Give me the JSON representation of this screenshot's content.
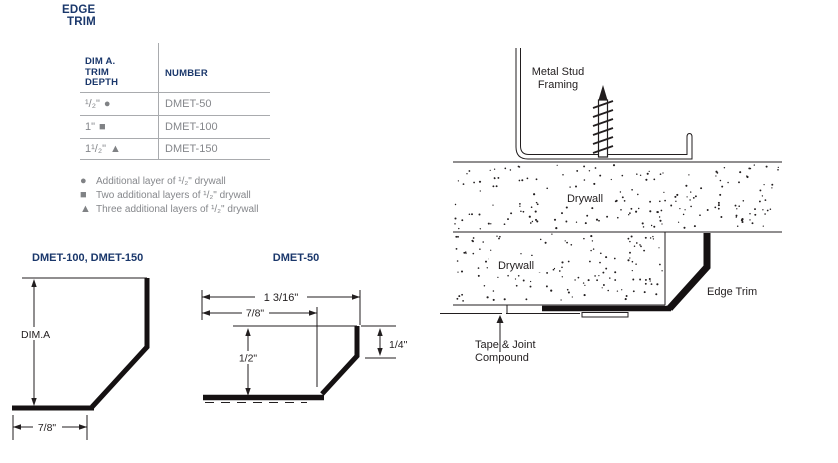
{
  "colors": {
    "navy": "#1a376b",
    "gray_text": "#85878b",
    "marker_gray": "#808285",
    "line_black": "#221e1f"
  },
  "page_title": {
    "line1": "EDGE",
    "line2": "TRIM"
  },
  "table": {
    "col1_header": "DIM A.\nTRIM\nDEPTH",
    "col2_header": "NUMBER",
    "rows": [
      {
        "depth": "¹/₂\"",
        "marker": "●",
        "marker_name": "circle",
        "number": "DMET-50"
      },
      {
        "depth": "1\"",
        "marker": "■",
        "marker_name": "square",
        "number": "DMET-100"
      },
      {
        "depth": "1¹/₂\"",
        "marker": "▲",
        "marker_name": "triangle",
        "number": "DMET-150"
      }
    ]
  },
  "legend": [
    {
      "marker": "●",
      "text": "Additional layer of ¹/₂\" drywall"
    },
    {
      "marker": "■",
      "text": "Two additional layers of ¹/₂\" drywall"
    },
    {
      "marker": "▲",
      "text": "Three additional layers of ¹/₂\" drywall"
    }
  ],
  "drawing_left": {
    "title": "DMET-100, DMET-150",
    "dim_vertical": "DIM.A",
    "dim_bottom": "7/8\""
  },
  "drawing_mid": {
    "title": "DMET-50",
    "dim_top": "1 3/16\"",
    "dim_second": "7/8\"",
    "dim_left": "1/2\"",
    "dim_right": "1/4\""
  },
  "installation": {
    "framing_line1": "Metal Stud",
    "framing_line2": "Framing",
    "drywall_top_label": "Drywall",
    "drywall_bottom_label": "Drywall",
    "edge_trim_label": "Edge Trim",
    "tape_line1": "Tape & Joint",
    "tape_line2": "Compound"
  }
}
